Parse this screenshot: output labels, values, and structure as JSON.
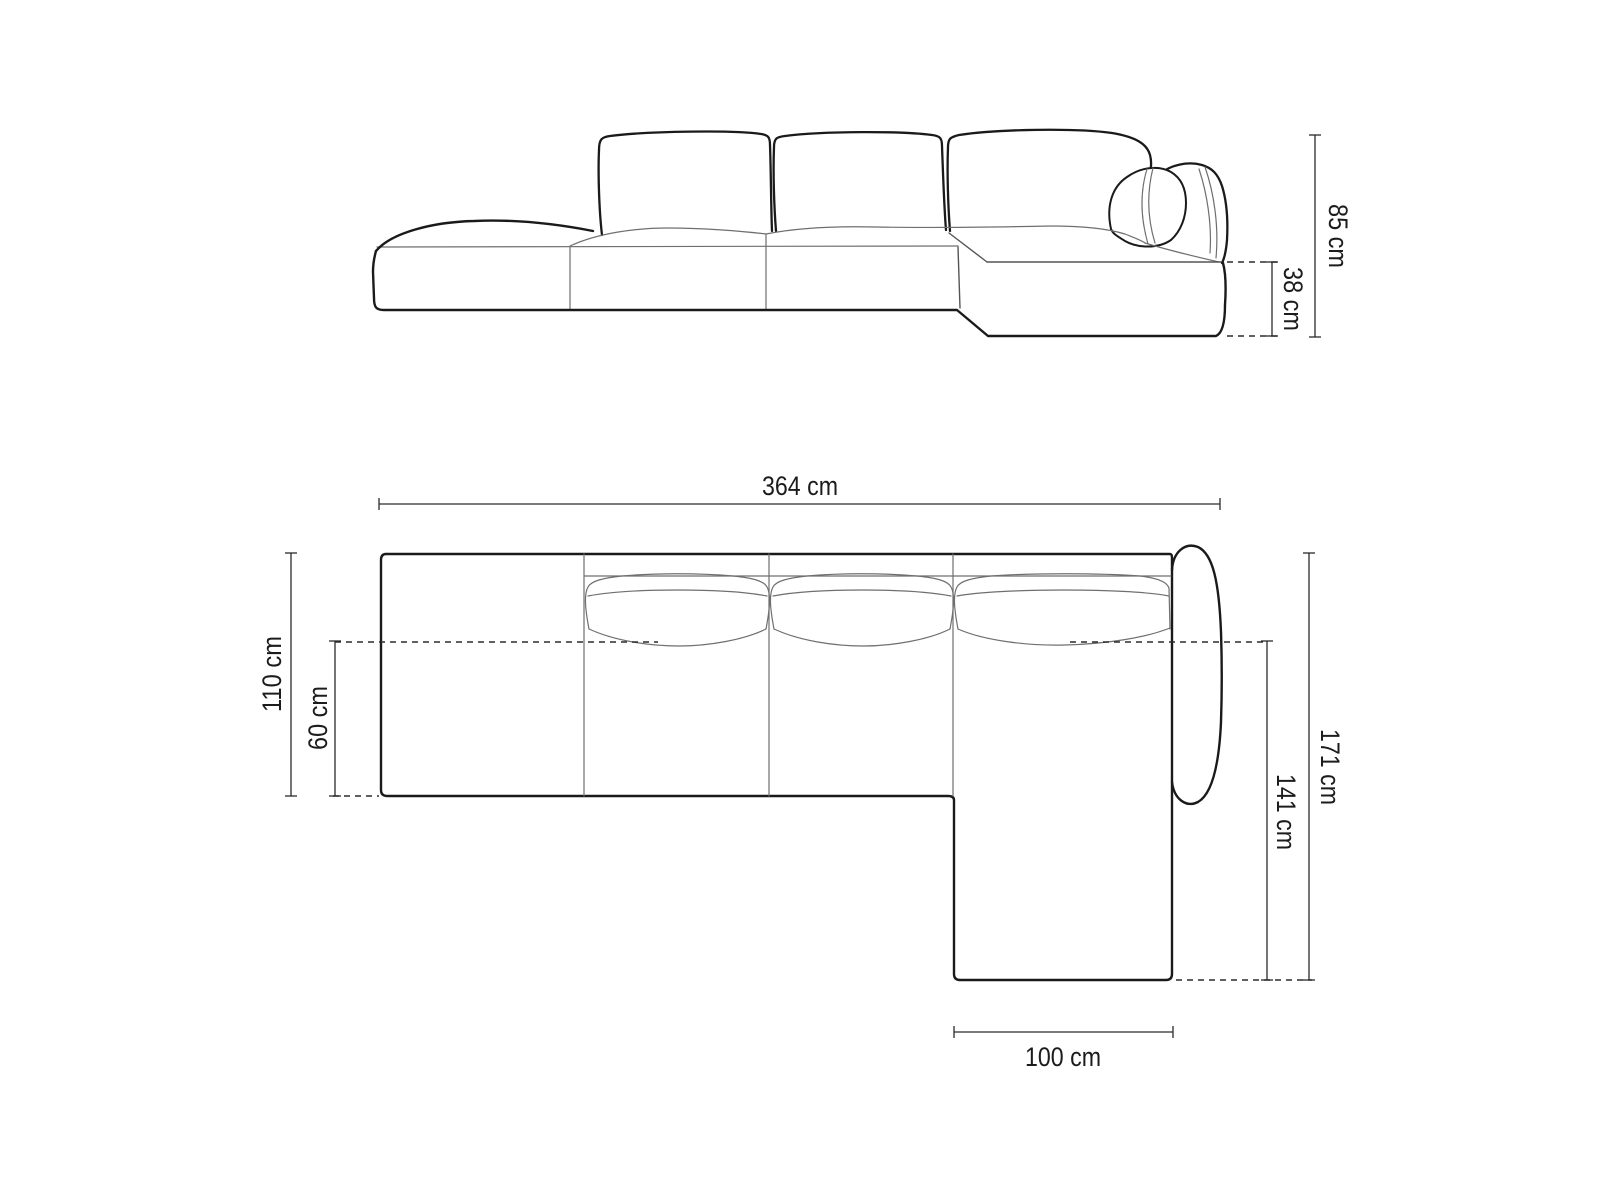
{
  "diagram": {
    "type": "furniture-dimension-drawing",
    "subject": "left-open-end corner sofa, front elevation and top plan view",
    "background_color": "#ffffff",
    "outline_color": "#1a1a1a",
    "detail_line_color": "#6f6f6f",
    "dimension_line_color": "#2b2b2b"
  },
  "dimensions": {
    "total_height": "85 cm",
    "base_height": "38 cm",
    "total_length": "364 cm",
    "total_depth": "110 cm",
    "seat_depth": "60 cm",
    "right_side_depth": "171 cm",
    "chaise_length": "141 cm",
    "chaise_width": "100 cm"
  }
}
